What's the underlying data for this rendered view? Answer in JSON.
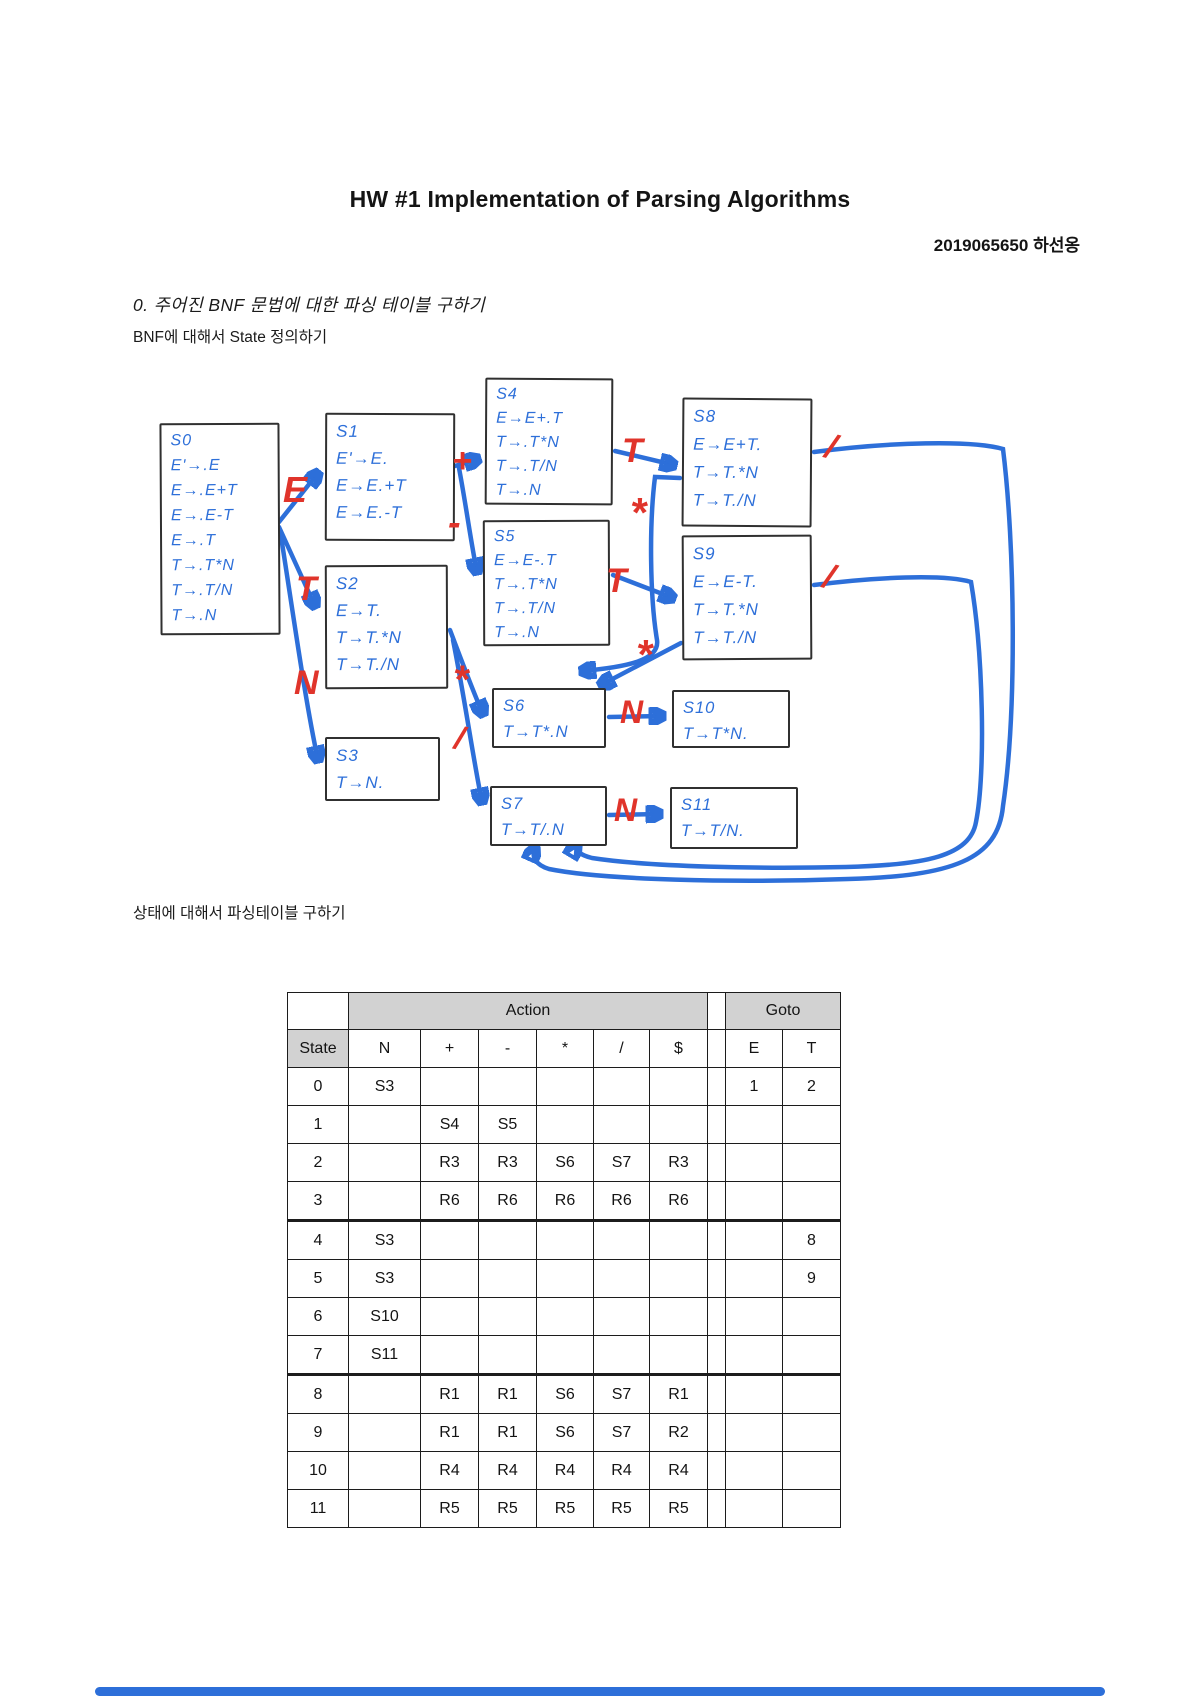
{
  "page": {
    "title": "HW #1 Implementation of Parsing Algorithms",
    "author": "2019065650 하선옹",
    "section_heading": "0. 주어진 BNF 문법에 대한 파싱 테이블 구하기",
    "subheading_states": "BNF에 대해서 State 정의하기",
    "subheading_table": "상태에 대해서 파싱테이블 구하기"
  },
  "colors": {
    "ink_blue": "#2d6fd9",
    "ink_red": "#e0342b",
    "table_gray": "#d2d2d2"
  },
  "diagram": {
    "states": [
      {
        "id": "S0",
        "lines": [
          "E'→.E",
          "E→.E+T",
          "E→.E-T",
          "E→.T",
          "T→.T*N",
          "T→.T/N",
          "T→.N"
        ]
      },
      {
        "id": "S1",
        "lines": [
          "E'→E.",
          "E→E.+T",
          "E→E.-T"
        ]
      },
      {
        "id": "S2",
        "lines": [
          "E→T.",
          "T→T.*N",
          "T→T./N"
        ]
      },
      {
        "id": "S3",
        "lines": [
          "T→N."
        ]
      },
      {
        "id": "S4",
        "lines": [
          "E→E+.T",
          "T→.T*N",
          "T→.T/N",
          "T→.N"
        ]
      },
      {
        "id": "S5",
        "lines": [
          "E→E-.T",
          "T→.T*N",
          "T→.T/N",
          "T→.N"
        ]
      },
      {
        "id": "S6",
        "lines": [
          "T→T*.N"
        ]
      },
      {
        "id": "S7",
        "lines": [
          "T→T/.N"
        ]
      },
      {
        "id": "S8",
        "lines": [
          "E→E+T.",
          "T→T.*N",
          "T→T./N"
        ]
      },
      {
        "id": "S9",
        "lines": [
          "E→E-T.",
          "T→T.*N",
          "T→T./N"
        ]
      },
      {
        "id": "S10",
        "lines": [
          "T→T*N."
        ]
      },
      {
        "id": "S11",
        "lines": [
          "T→T/N."
        ]
      }
    ],
    "edges": [
      {
        "from": "S0",
        "to": "S1",
        "label": "E"
      },
      {
        "from": "S0",
        "to": "S2",
        "label": "T"
      },
      {
        "from": "S0",
        "to": "S3",
        "label": "N"
      },
      {
        "from": "S1",
        "to": "S4",
        "label": "+"
      },
      {
        "from": "S1",
        "to": "S5",
        "label": "-"
      },
      {
        "from": "S4",
        "to": "S8",
        "label": "T"
      },
      {
        "from": "S5",
        "to": "S9",
        "label": "T"
      },
      {
        "from": "S2",
        "to": "S6",
        "label": "*"
      },
      {
        "from": "S2",
        "to": "S7",
        "label": "/"
      },
      {
        "from": "S8",
        "to": "S6",
        "label": "*"
      },
      {
        "from": "S9",
        "to": "S6",
        "label": "*"
      },
      {
        "from": "S6",
        "to": "S10",
        "label": "N"
      },
      {
        "from": "S7",
        "to": "S11",
        "label": "N"
      },
      {
        "from": "S8",
        "to": "S7",
        "label": "/"
      },
      {
        "from": "S9",
        "to": "S7",
        "label": "/"
      }
    ]
  },
  "table": {
    "action_header": "Action",
    "goto_header": "Goto",
    "state_header": "State",
    "action_cols": [
      "N",
      "+",
      "-",
      "*",
      "/",
      "$"
    ],
    "goto_cols": [
      "E",
      "T"
    ],
    "rows": [
      {
        "state": "0",
        "cells": [
          "S3",
          "",
          "",
          "",
          "",
          ""
        ],
        "goto": [
          "1",
          "2"
        ]
      },
      {
        "state": "1",
        "cells": [
          "",
          "S4",
          "S5",
          "",
          "",
          ""
        ],
        "goto": [
          "",
          ""
        ]
      },
      {
        "state": "2",
        "cells": [
          "",
          "R3",
          "R3",
          "S6",
          "S7",
          "R3"
        ],
        "goto": [
          "",
          ""
        ]
      },
      {
        "state": "3",
        "cells": [
          "",
          "R6",
          "R6",
          "R6",
          "R6",
          "R6"
        ],
        "goto": [
          "",
          ""
        ]
      },
      {
        "state": "4",
        "cells": [
          "S3",
          "",
          "",
          "",
          "",
          ""
        ],
        "goto": [
          "",
          "8"
        ]
      },
      {
        "state": "5",
        "cells": [
          "S3",
          "",
          "",
          "",
          "",
          ""
        ],
        "goto": [
          "",
          "9"
        ]
      },
      {
        "state": "6",
        "cells": [
          "S10",
          "",
          "",
          "",
          "",
          ""
        ],
        "goto": [
          "",
          ""
        ]
      },
      {
        "state": "7",
        "cells": [
          "S11",
          "",
          "",
          "",
          "",
          ""
        ],
        "goto": [
          "",
          ""
        ]
      },
      {
        "state": "8",
        "cells": [
          "",
          "R1",
          "R1",
          "S6",
          "S7",
          "R1"
        ],
        "goto": [
          "",
          ""
        ]
      },
      {
        "state": "9",
        "cells": [
          "",
          "R1",
          "R1",
          "S6",
          "S7",
          "R2"
        ],
        "goto": [
          "",
          ""
        ]
      },
      {
        "state": "10",
        "cells": [
          "",
          "R4",
          "R4",
          "R4",
          "R4",
          "R4"
        ],
        "goto": [
          "",
          ""
        ]
      },
      {
        "state": "11",
        "cells": [
          "",
          "R5",
          "R5",
          "R5",
          "R5",
          "R5"
        ],
        "goto": [
          "",
          ""
        ]
      }
    ]
  }
}
